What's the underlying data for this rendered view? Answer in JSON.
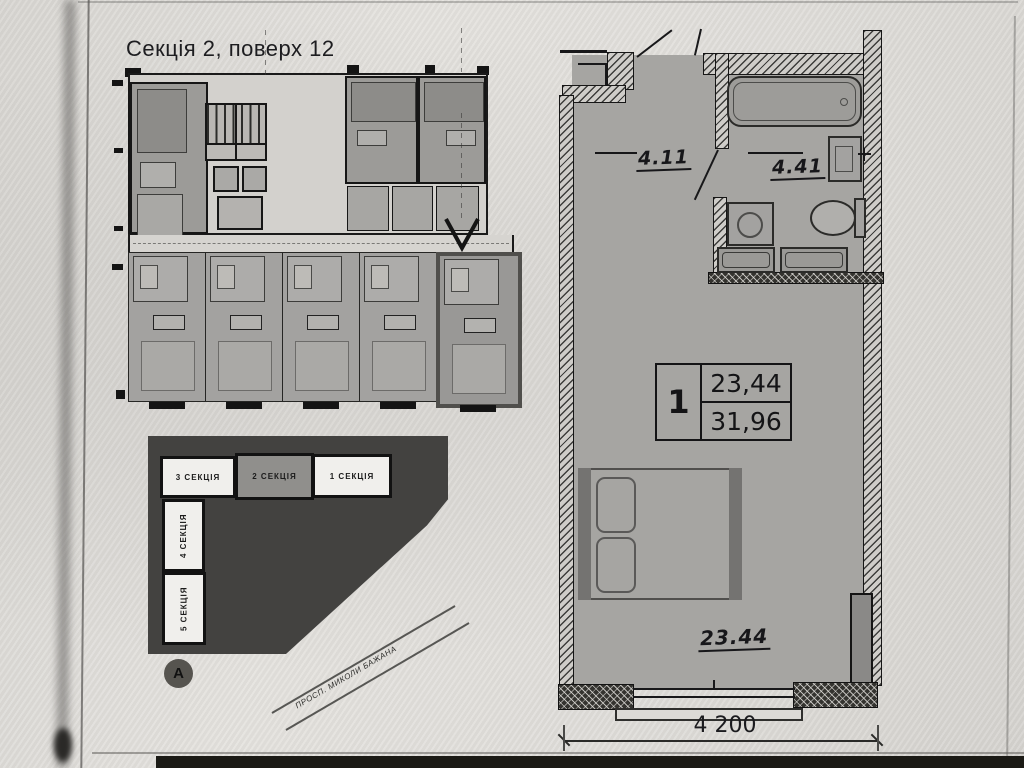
{
  "title": "Секція 2, поверх 12",
  "key_plan": {
    "sections_top": [
      {
        "label": "3 СЕКЦІЯ",
        "highlighted": false
      },
      {
        "label": "2 СЕКЦІЯ",
        "highlighted": true
      },
      {
        "label": "1 СЕКЦІЯ",
        "highlighted": false
      }
    ],
    "sections_left": [
      {
        "label": "4 СЕКЦІЯ"
      },
      {
        "label": "5 СЕКЦІЯ"
      }
    ],
    "axis_marker": "А",
    "street_label": "ПРОСП. МИКОЛИ БАЖАНА"
  },
  "apartment_plan": {
    "info_box": {
      "rooms": "1",
      "living_area": "23,44",
      "total_area": "31,96"
    },
    "room_labels": {
      "hallway": "4.11",
      "bathroom": "4.41",
      "living_room": "23.44"
    },
    "dimensions": {
      "width": "4 200"
    }
  },
  "colors": {
    "paper": "#dfddd9",
    "ink": "#18181a",
    "room_fill": "#a6a5a2",
    "key_plan_fill": "#434240",
    "highlighted_section_fill": "#908f8c"
  }
}
